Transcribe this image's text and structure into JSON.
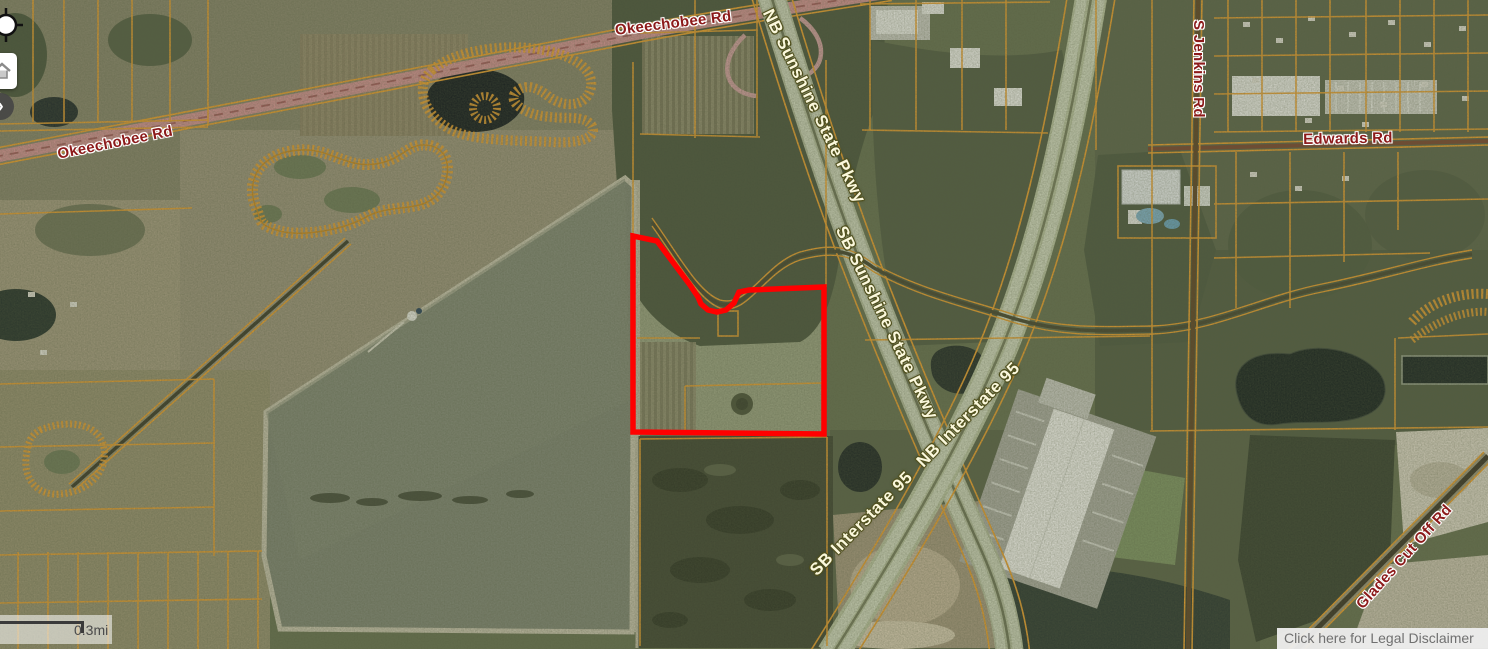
{
  "map": {
    "road_labels": {
      "okeechobee_rd_west": "Okeechobee Rd",
      "okeechobee_rd_north": "Okeechobee Rd",
      "nb_sunshine_state_pkwy": "NB Sunshine State Pkwy",
      "sb_sunshine_state_pkwy": "SB Sunshine State Pkwy",
      "sb_interstate_95": "SB Interstate 95",
      "nb_interstate_95": "NB Interstate 95",
      "s_jenkins_rd": "S Jenkins Rd",
      "edwards_rd": "Edwards Rd",
      "glades_cut_off_rd": "Glades Cut Off Rd"
    },
    "selected_parcel": {
      "outline_color": "#FF0000"
    },
    "style_colors": {
      "parcel_line": "#E89E2D",
      "street_label": "#8C1A1A",
      "highway_label": "#FBF8DC",
      "highway_label_halo": "#50501E"
    },
    "scale_bar": {
      "distance_label": "0.3mi"
    },
    "disclaimer": {
      "link_text": "Click here for Legal Disclaimer"
    },
    "controls": {
      "icons": [
        "crosshair-icon",
        "home-icon",
        "chevron-right-icon"
      ]
    }
  }
}
